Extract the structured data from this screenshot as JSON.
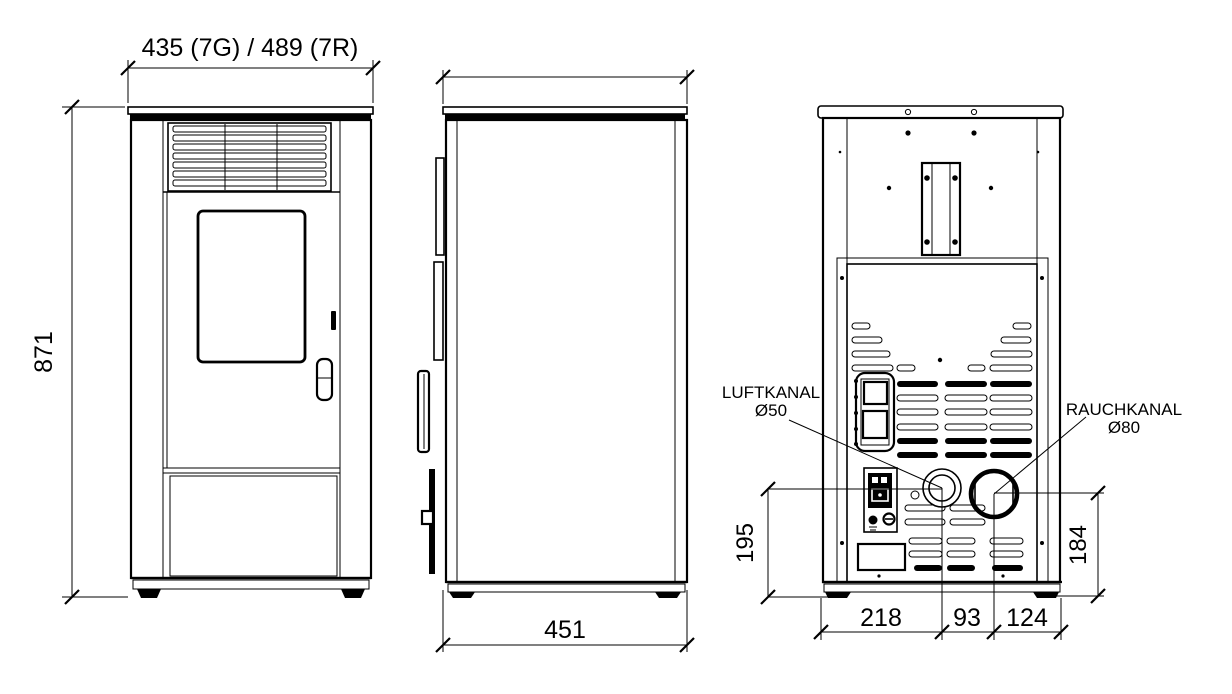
{
  "drawing": {
    "type": "technical-dimension-drawing",
    "subject": "Pellet stove — front, side and rear elevation views",
    "units": "mm",
    "colors": {
      "line": "#000000",
      "background": "#ffffff"
    }
  },
  "front": {
    "width_dim": "435 (7G) / 489 (7R)",
    "height_dim": "871"
  },
  "side": {
    "depth_dim": "451"
  },
  "rear": {
    "air_duct_label": "LUFTKANAL",
    "air_duct_size": "Ø50",
    "smoke_duct_label": "RAUCHKANAL",
    "smoke_duct_size": "Ø80",
    "left_height_dim": "195",
    "right_height_dim": "184",
    "bottom_dims": [
      "218",
      "93",
      "124"
    ]
  }
}
